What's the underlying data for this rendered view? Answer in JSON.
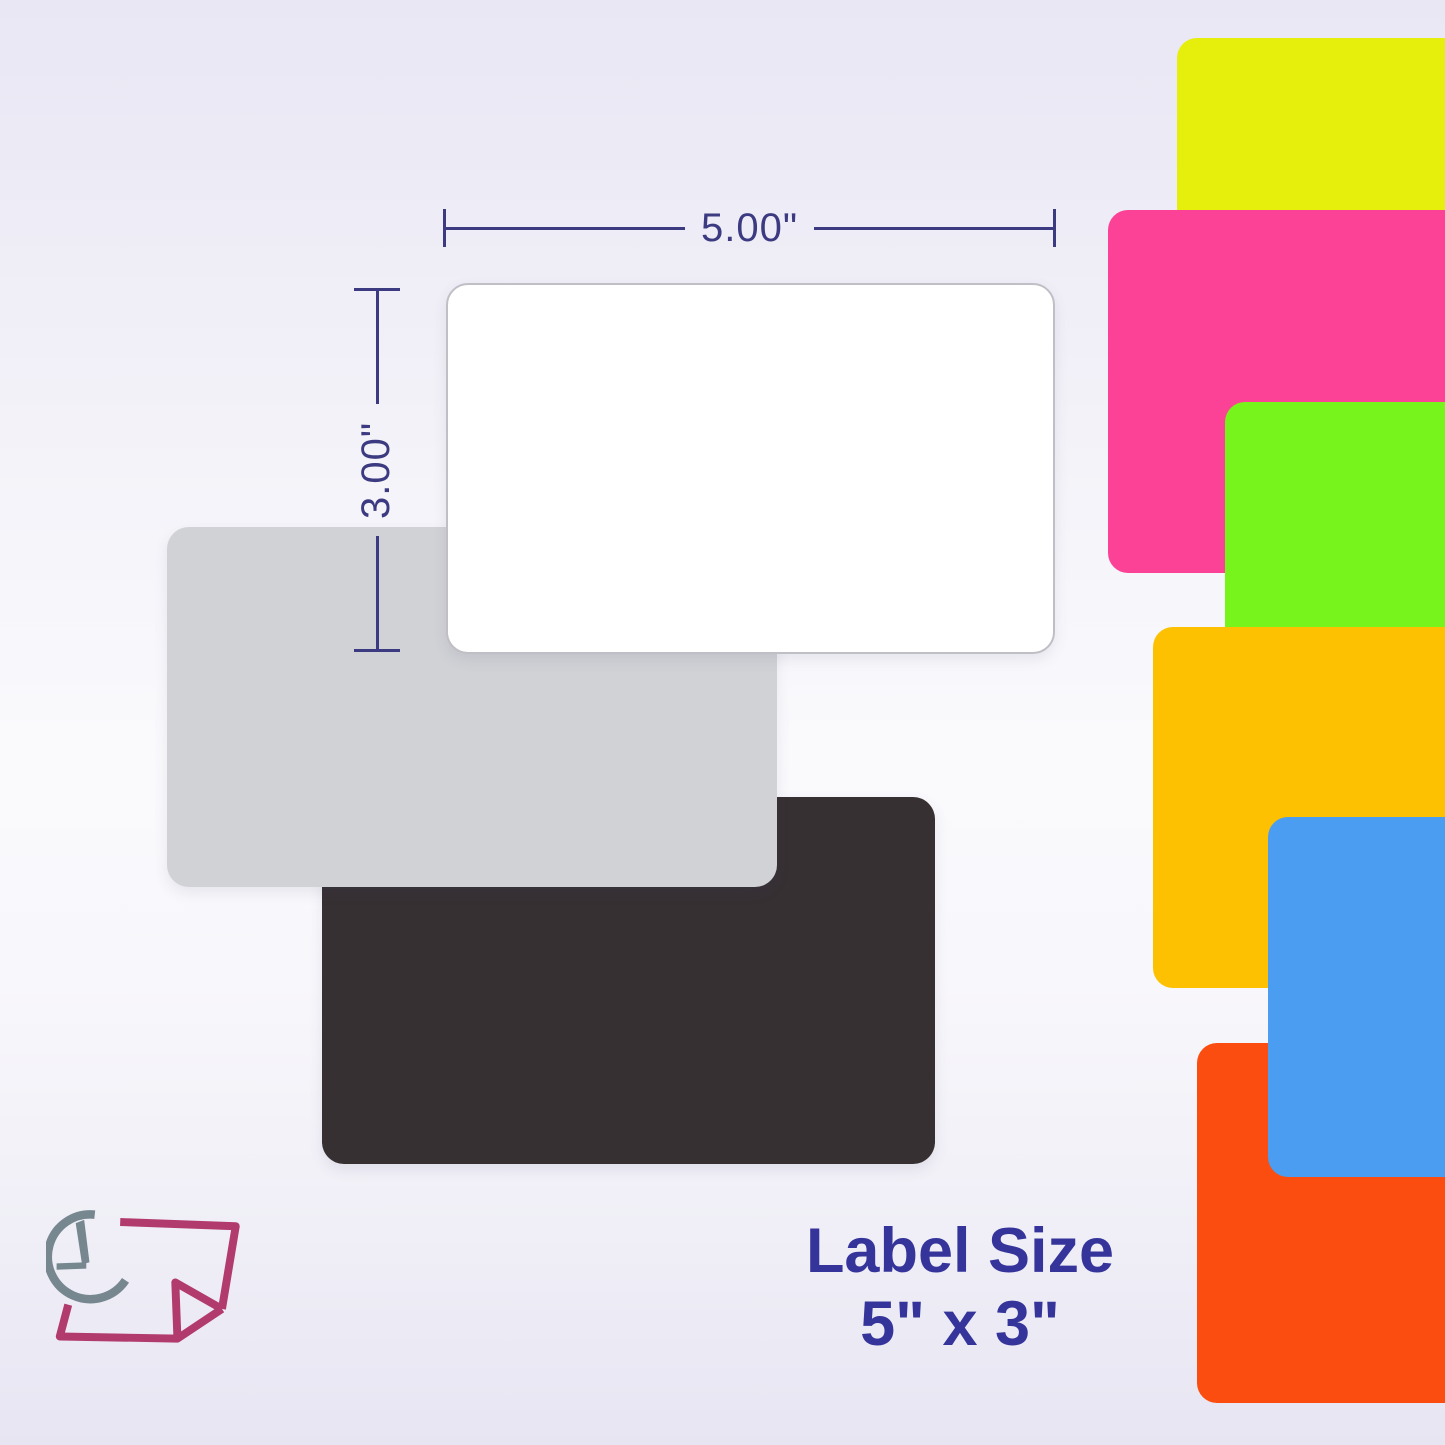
{
  "diagram": {
    "width_label": "5.00\"",
    "height_label": "3.00\"",
    "labels": [
      {
        "name": "white",
        "color": "#ffffff"
      },
      {
        "name": "gray",
        "color": "#d1d2d6"
      },
      {
        "name": "black",
        "color": "#363033"
      }
    ]
  },
  "swatches": [
    {
      "name": "yellow",
      "color": "#e6ee0c"
    },
    {
      "name": "pink",
      "color": "#fb4296"
    },
    {
      "name": "green",
      "color": "#77f41c"
    },
    {
      "name": "orange",
      "color": "#fdc101"
    },
    {
      "name": "blue",
      "color": "#4a9df0"
    },
    {
      "name": "red",
      "color": "#fb4d0f"
    }
  ],
  "caption": {
    "line1": "Label Size",
    "line2": "5\" x 3\""
  },
  "colors": {
    "dimension": "#3c3a80",
    "caption": "#35349b",
    "logo_gray": "#76878f",
    "logo_magenta": "#b23b6d"
  }
}
